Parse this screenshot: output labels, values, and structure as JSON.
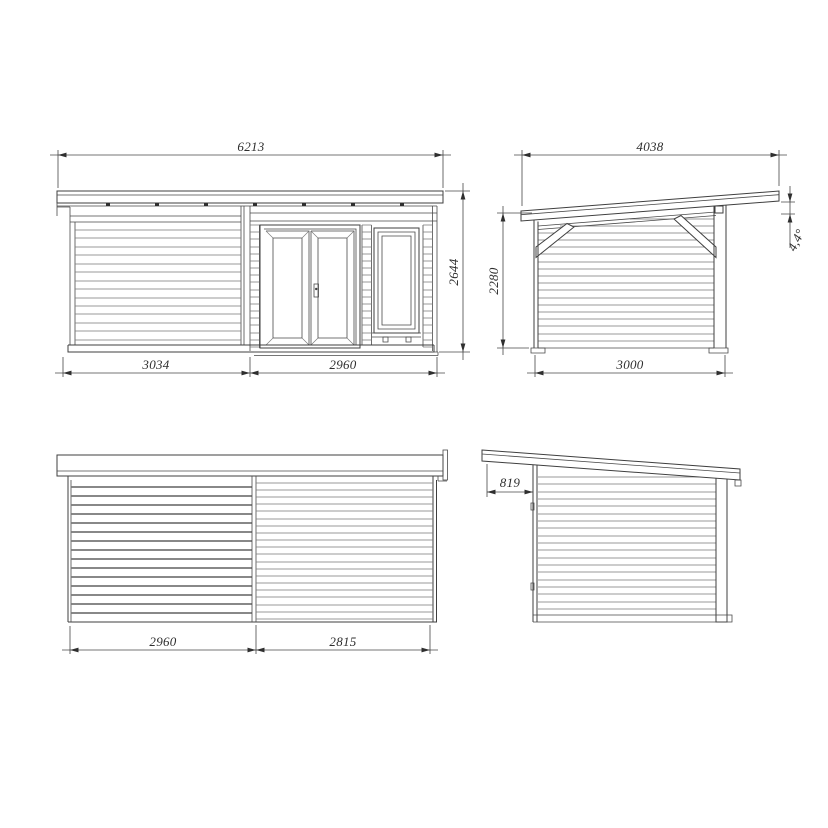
{
  "drawing": {
    "type": "technical-elevation-drawing",
    "subject": "garden cabin with lean-to roof, four elevation views",
    "units": "mm",
    "colors": {
      "line": "#3f3f3f",
      "siding": "#7a7a7a",
      "text": "#2e2e2e",
      "background": "#ffffff"
    },
    "views": {
      "front": {
        "label": "front-elevation",
        "dims": {
          "total_width": "6213",
          "height": "2644",
          "porch_width": "3034",
          "cabin_width": "2960"
        }
      },
      "side_a": {
        "label": "right-side-elevation",
        "dims": {
          "roof_length": "4038",
          "wall_height": "2280",
          "depth": "3000",
          "roof_angle": "4,4°"
        }
      },
      "rear": {
        "label": "rear-elevation",
        "dims": {
          "left_width": "2960",
          "right_width": "2815"
        }
      },
      "side_b": {
        "label": "left-side-elevation",
        "dims": {
          "roof_overhang": "819"
        }
      }
    }
  }
}
